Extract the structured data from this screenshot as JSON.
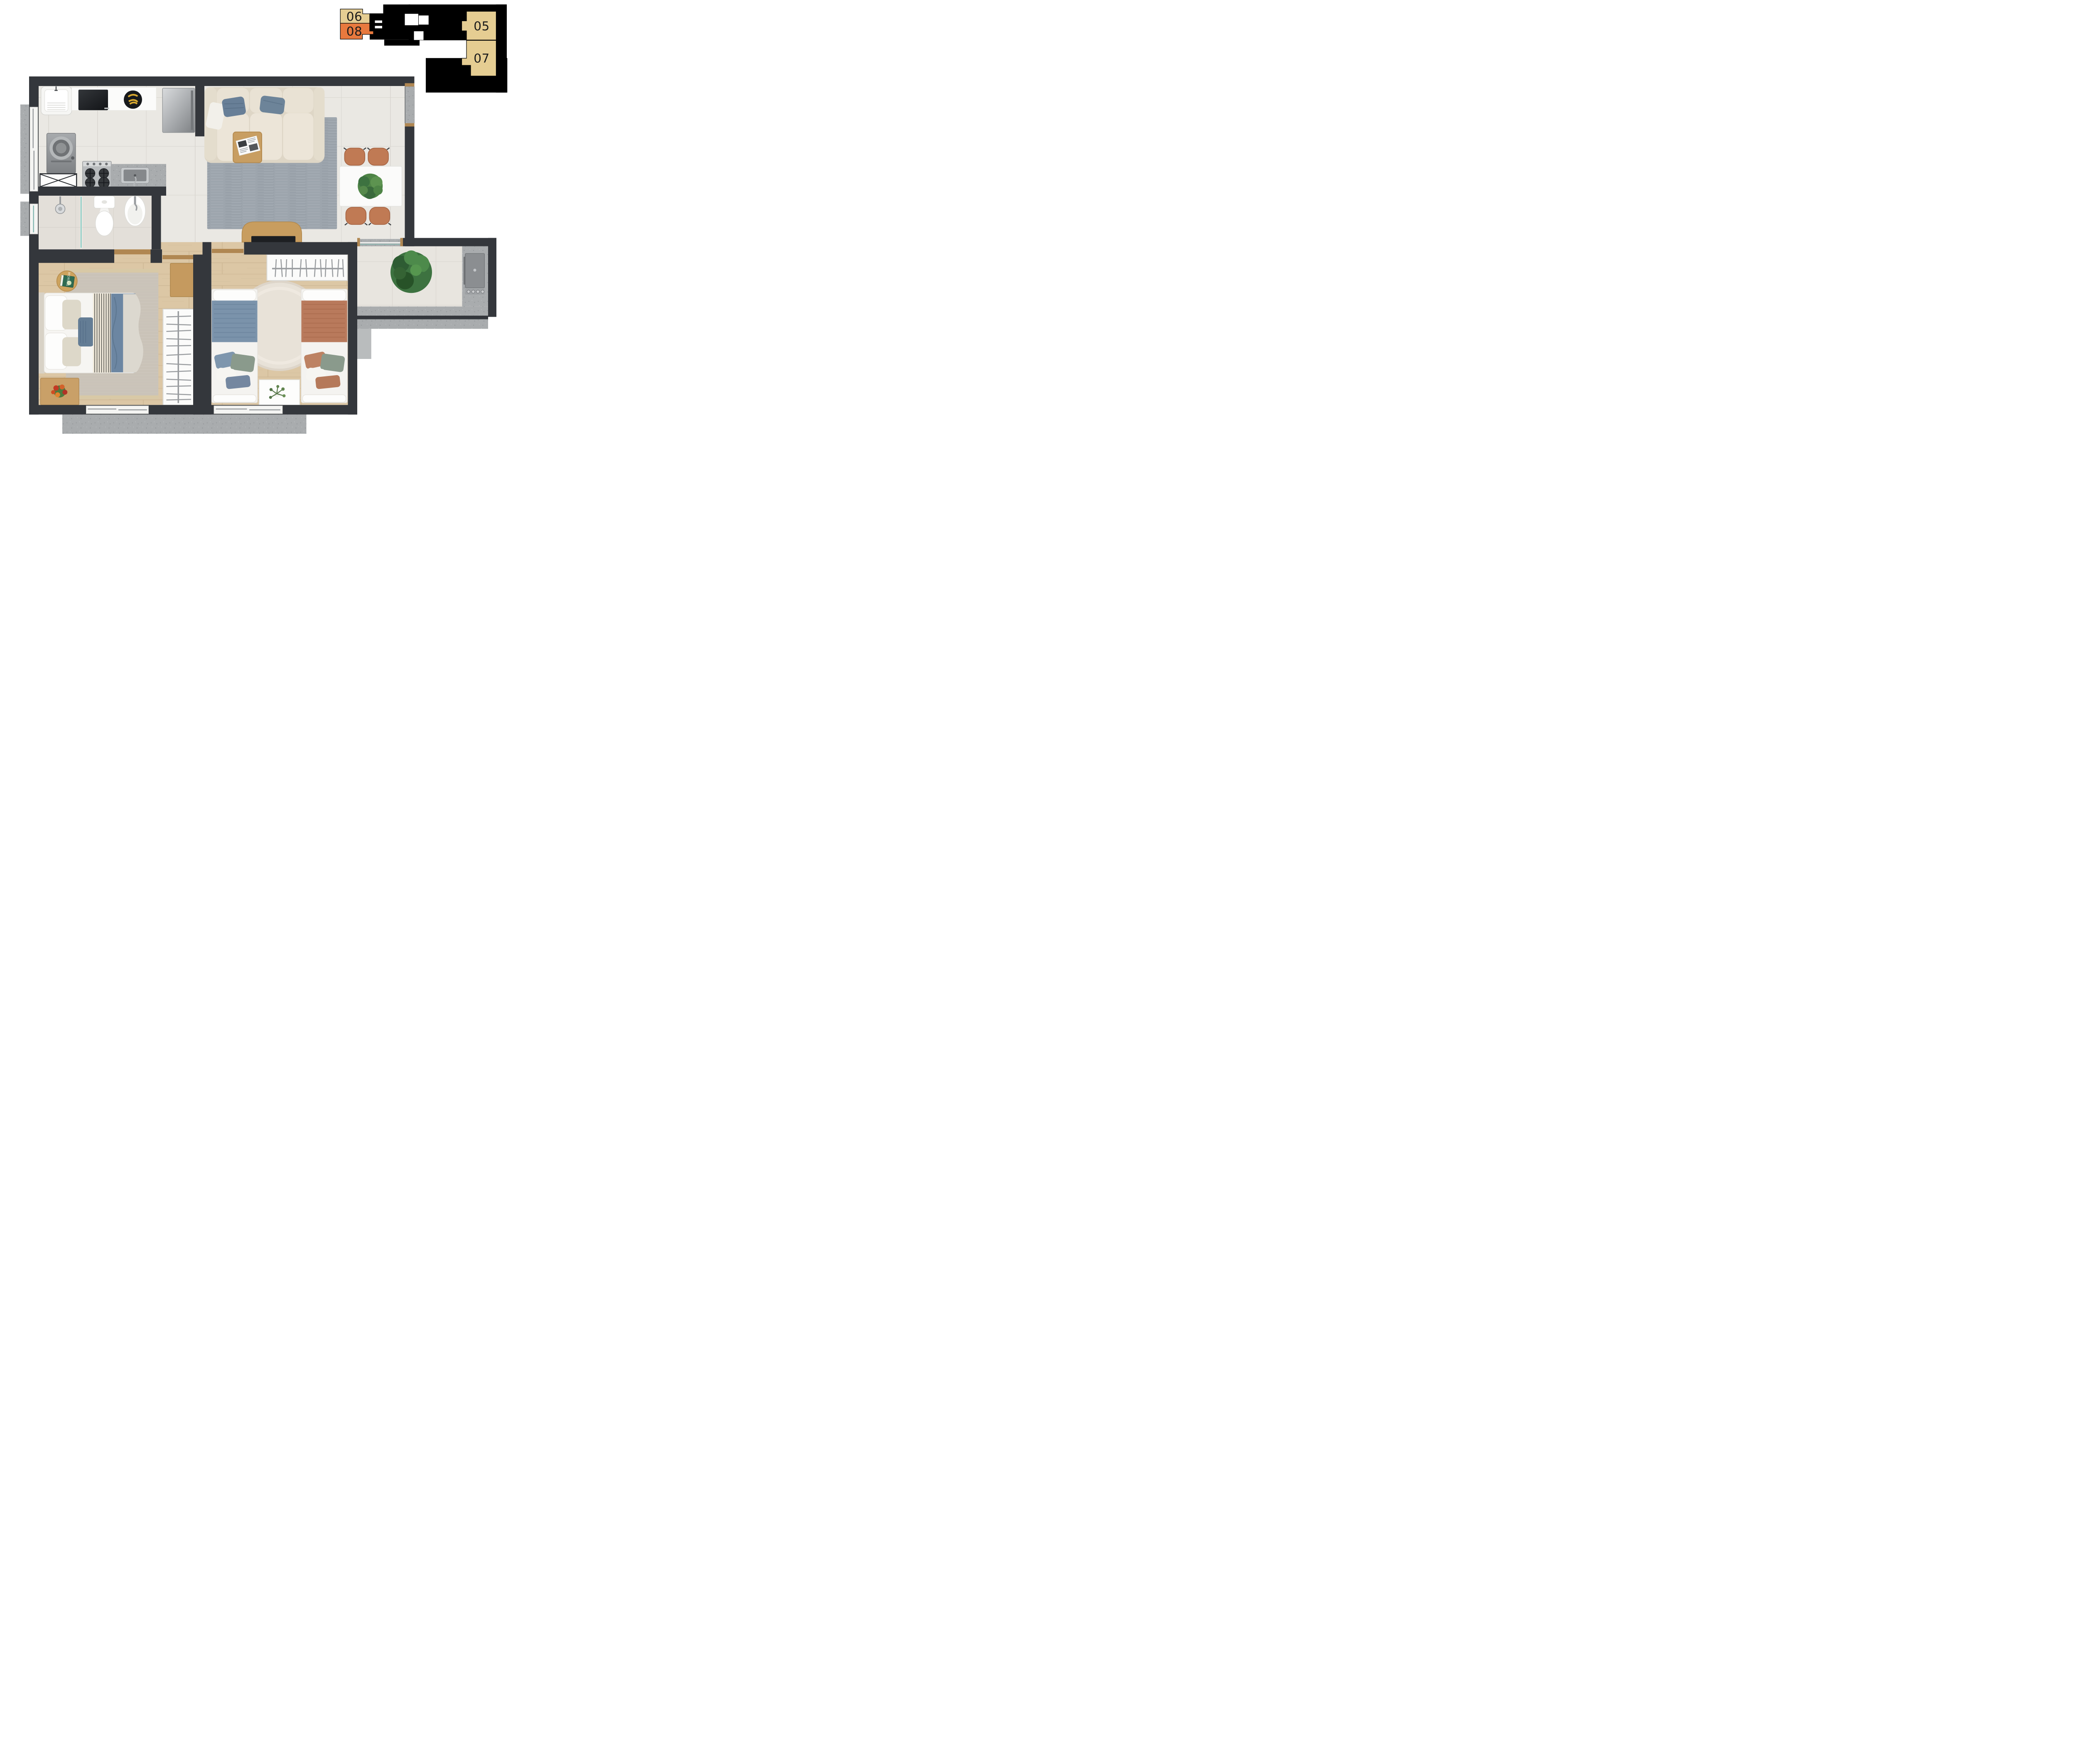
{
  "title": "apartment-floor-plan-top-view",
  "key_plan": {
    "description": "building key plan, current unit highlighted",
    "units": [
      {
        "label": "06",
        "status": "other",
        "color": "#e5cd92"
      },
      {
        "label": "08",
        "status": "current",
        "color": "#e8793e"
      },
      {
        "label": "05",
        "status": "other",
        "color": "#e5cd92"
      },
      {
        "label": "07",
        "status": "other",
        "color": "#e5cd92"
      }
    ],
    "core_color": "#000000",
    "elevator_color": "#ffffff"
  },
  "floor_plan": {
    "rooms": [
      {
        "name": "kitchen",
        "floor": "light-tile"
      },
      {
        "name": "living-dining",
        "floor": "light-tile"
      },
      {
        "name": "bathroom",
        "floor": "light-tile"
      },
      {
        "name": "hallway",
        "floor": "wood"
      },
      {
        "name": "master-bedroom",
        "floor": "wood"
      },
      {
        "name": "second-bedroom",
        "floor": "wood"
      },
      {
        "name": "balcony-grill",
        "floor": "light-tile"
      }
    ],
    "furniture": {
      "kitchen": [
        "laundry-tank",
        "white-counter",
        "black-countertop-appliance",
        "fruit-bowl-bananas",
        "refrigerator",
        "washing-machine",
        "base-cabinet-x",
        "gas-stove-4-burners",
        "granite-counter-with-sink"
      ],
      "living": [
        "beige-sofa-3-seats",
        "blue-pillows",
        "gray-area-rug",
        "wood-coffee-table",
        "magazine",
        "white-dining-table",
        "terracotta-chairs-x4",
        "table-plant",
        "tv-wood-panel",
        "tv"
      ],
      "bathroom": [
        "shower-head",
        "glass-partition",
        "toilet",
        "oval-sink"
      ],
      "master-bedroom": [
        "double-bed-blue-duvet",
        "striped-runner",
        "round-side-table",
        "book",
        "nightstand-with-flowers",
        "open-wardrobe-hangers",
        "wood-desk",
        "knit-rug"
      ],
      "second-bedroom": [
        "single-bed-blue",
        "single-bed-terracotta",
        "round-shag-rug",
        "open-wardrobe-hangers",
        "white-side-table-plant"
      ],
      "balcony": [
        "large-potted-plant",
        "grill-station",
        "granite-counter"
      ]
    },
    "book_title": "MORRIS"
  },
  "palette": {
    "wall": "#34373c",
    "tile_floor": "#eae8e3",
    "wood_floor": "#dcc7a5",
    "granite": "#a9acae",
    "sofa_beige": "#e7e0d2",
    "pillow_blue": "#687f97",
    "blanket_blue": "#7b93ab",
    "blanket_terracotta": "#b97a5c",
    "chair_terracotta": "#c07a54",
    "rug_gray": "#9da5ad",
    "plant_green": "#3d7240",
    "highlight_orange": "#e8793e",
    "keyplan_beige": "#e5cd92"
  }
}
